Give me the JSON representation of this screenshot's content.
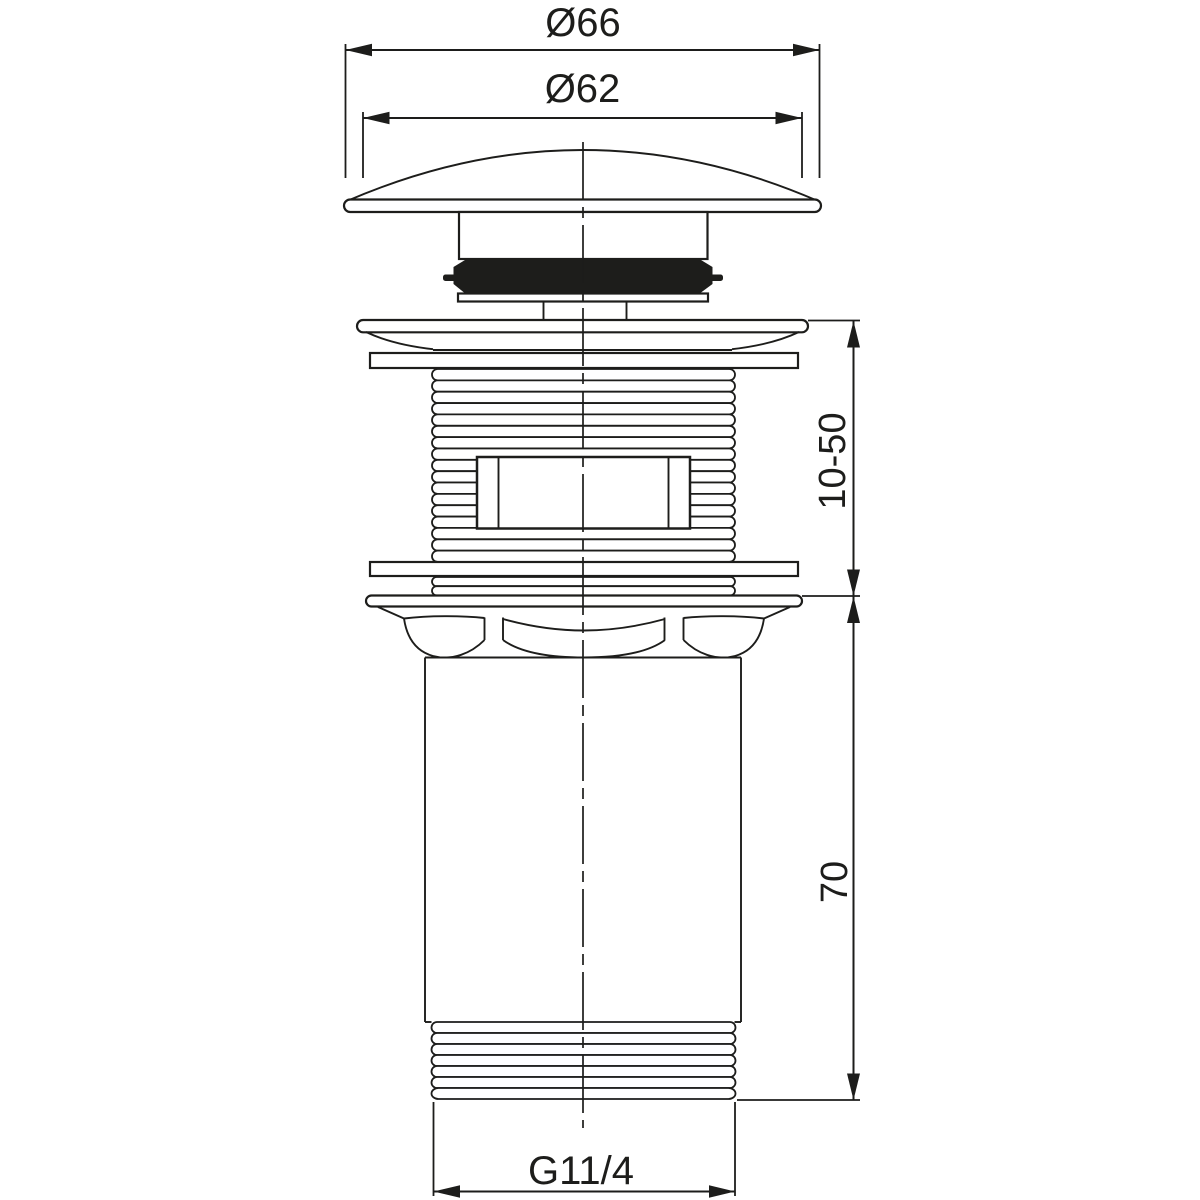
{
  "drawing": {
    "background": "#ffffff",
    "line_color": "#1d1d1b",
    "seal_color": "#1d1d1b",
    "labels": {
      "cap_outer_diameter": "Ø66",
      "cap_top_diameter": "Ø62",
      "clamping_range": "10-50",
      "tailpiece_length": "70",
      "thread_size": "G11/4"
    }
  }
}
